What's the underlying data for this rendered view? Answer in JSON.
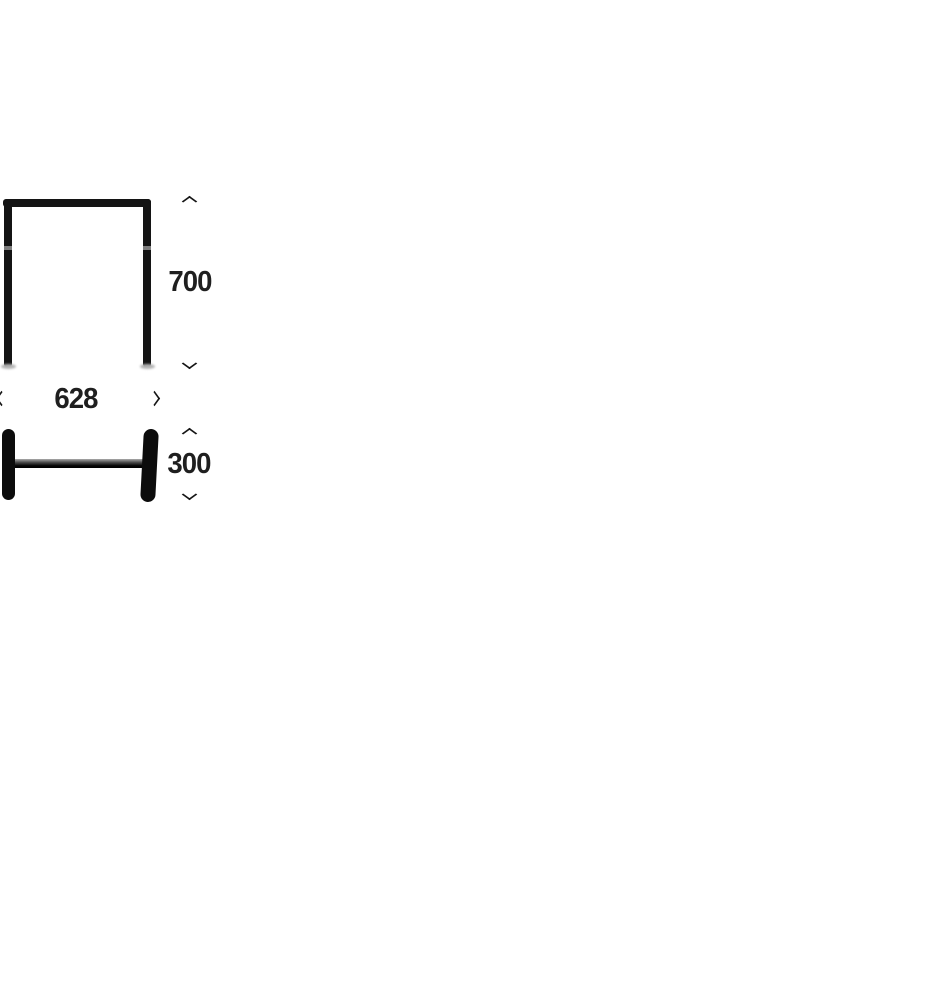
{
  "canvas": {
    "background": "#ffffff"
  },
  "diagram": {
    "line_color": "#141414",
    "text_color": "#1f1f1f",
    "dimensions": [
      {
        "id": "frame-height",
        "label": "700",
        "orientation": "vertical"
      },
      {
        "id": "frame-width",
        "label": "628",
        "orientation": "horizontal"
      },
      {
        "id": "wheel-assembly-height",
        "label": "300",
        "orientation": "vertical"
      }
    ]
  }
}
